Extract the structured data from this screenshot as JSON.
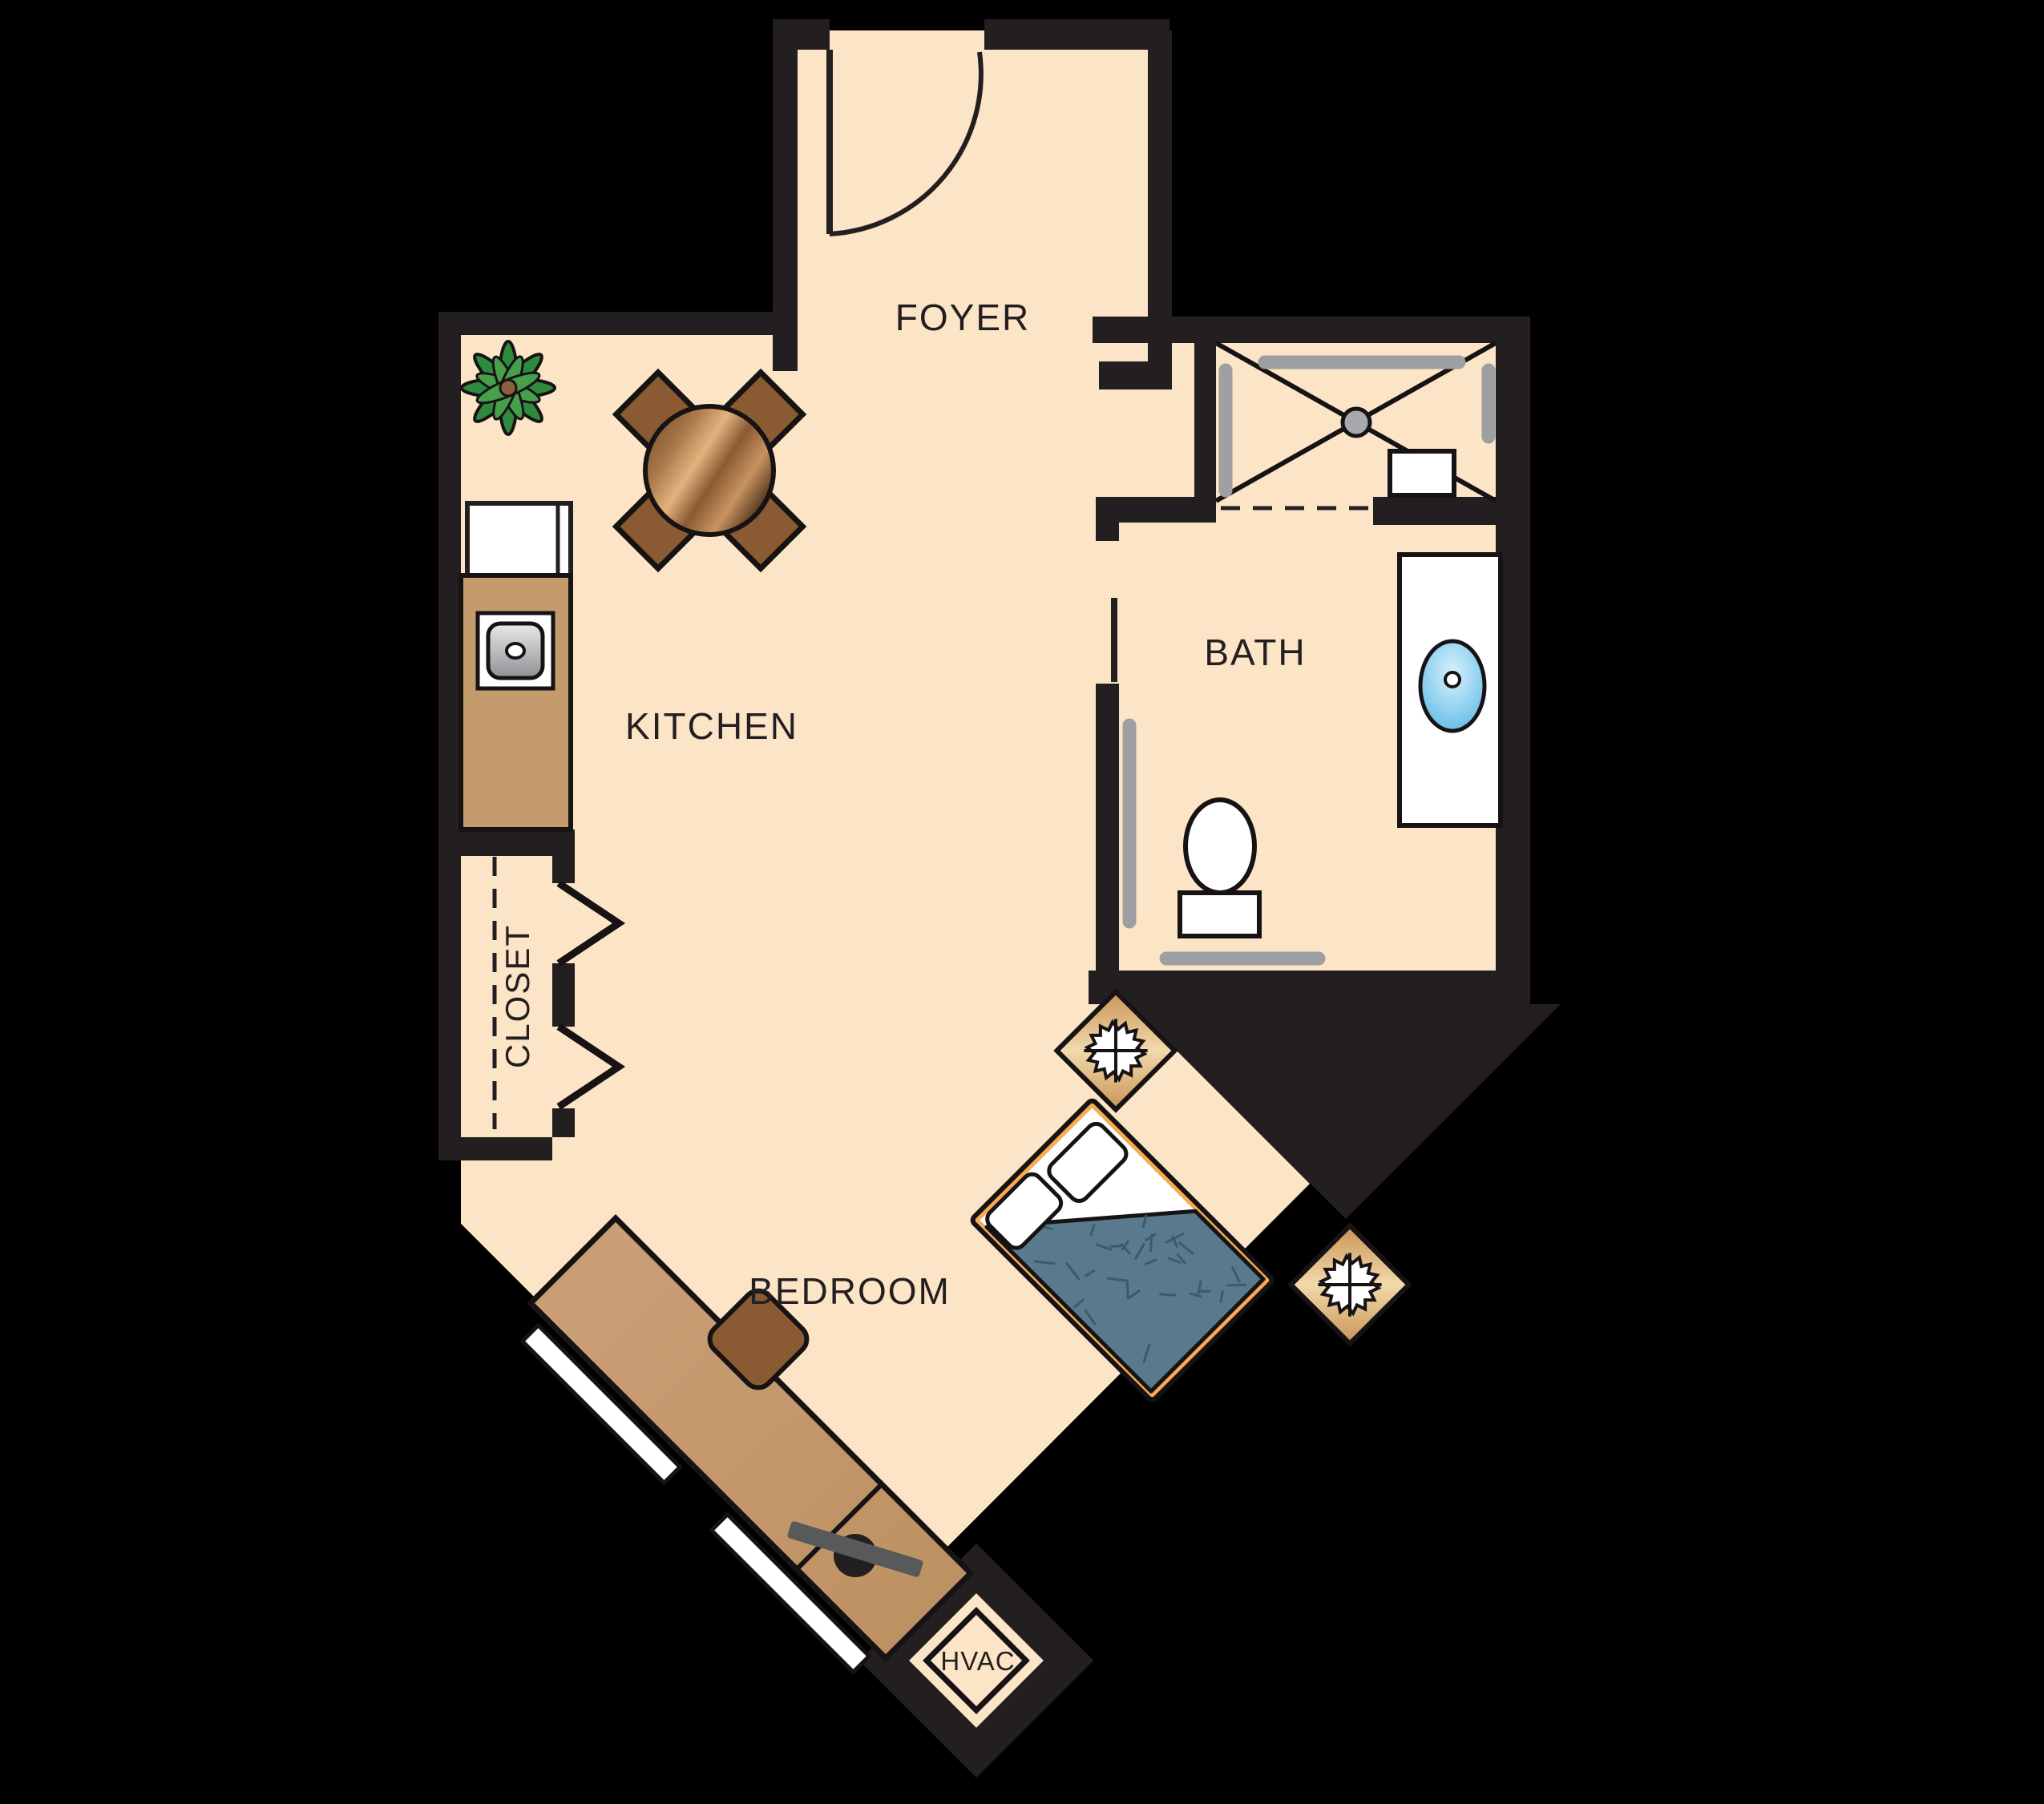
{
  "floorplan": {
    "title": "Studio apartment floor plan",
    "rooms": [
      {
        "label": "FOYER"
      },
      {
        "label": "KITCHEN"
      },
      {
        "label": "BATH"
      },
      {
        "label": "CLOSET"
      },
      {
        "label": "BEDROOM"
      },
      {
        "label": "HVAC"
      }
    ],
    "furniture_icons": [
      "entry-door-icon",
      "dining-table-icon",
      "dining-chair-icon",
      "plant-icon",
      "refrigerator-icon",
      "kitchen-counter-icon",
      "kitchen-sink-icon",
      "shower-icon",
      "shower-drain-icon",
      "shower-seat-icon",
      "grab-bar-icon",
      "toilet-icon",
      "vanity-icon",
      "vanity-sink-icon",
      "bath-door-icon",
      "bifold-door-icon",
      "bed-icon",
      "pillow-icon",
      "comforter-icon",
      "nightstand-icon",
      "starburst-icon",
      "desk-icon",
      "desk-chair-icon",
      "tv-icon",
      "window-icon",
      "hvac-unit-icon"
    ],
    "colors": {
      "background": "#000000",
      "wall": "#231F20",
      "floor": "#FCE4C6",
      "counter_tan": "#C49B6D",
      "chair_brown": "#8A5A33",
      "table_wood_dark": "#5E3A1C",
      "table_wood_light": "#E2B37E",
      "bed_frame_orange": "#F6AC55",
      "comforter_blue": "#587A8C",
      "grab_bar_gray": "#9D9FA2",
      "sink_blue": "#8ED0F0",
      "basin_gray": "#9A9C9F",
      "plant_green_dark": "#2E8B3D",
      "plant_green_light": "#46A04B",
      "nightstand_light": "#F2D9AC",
      "nightstand_dark": "#C89455"
    }
  }
}
